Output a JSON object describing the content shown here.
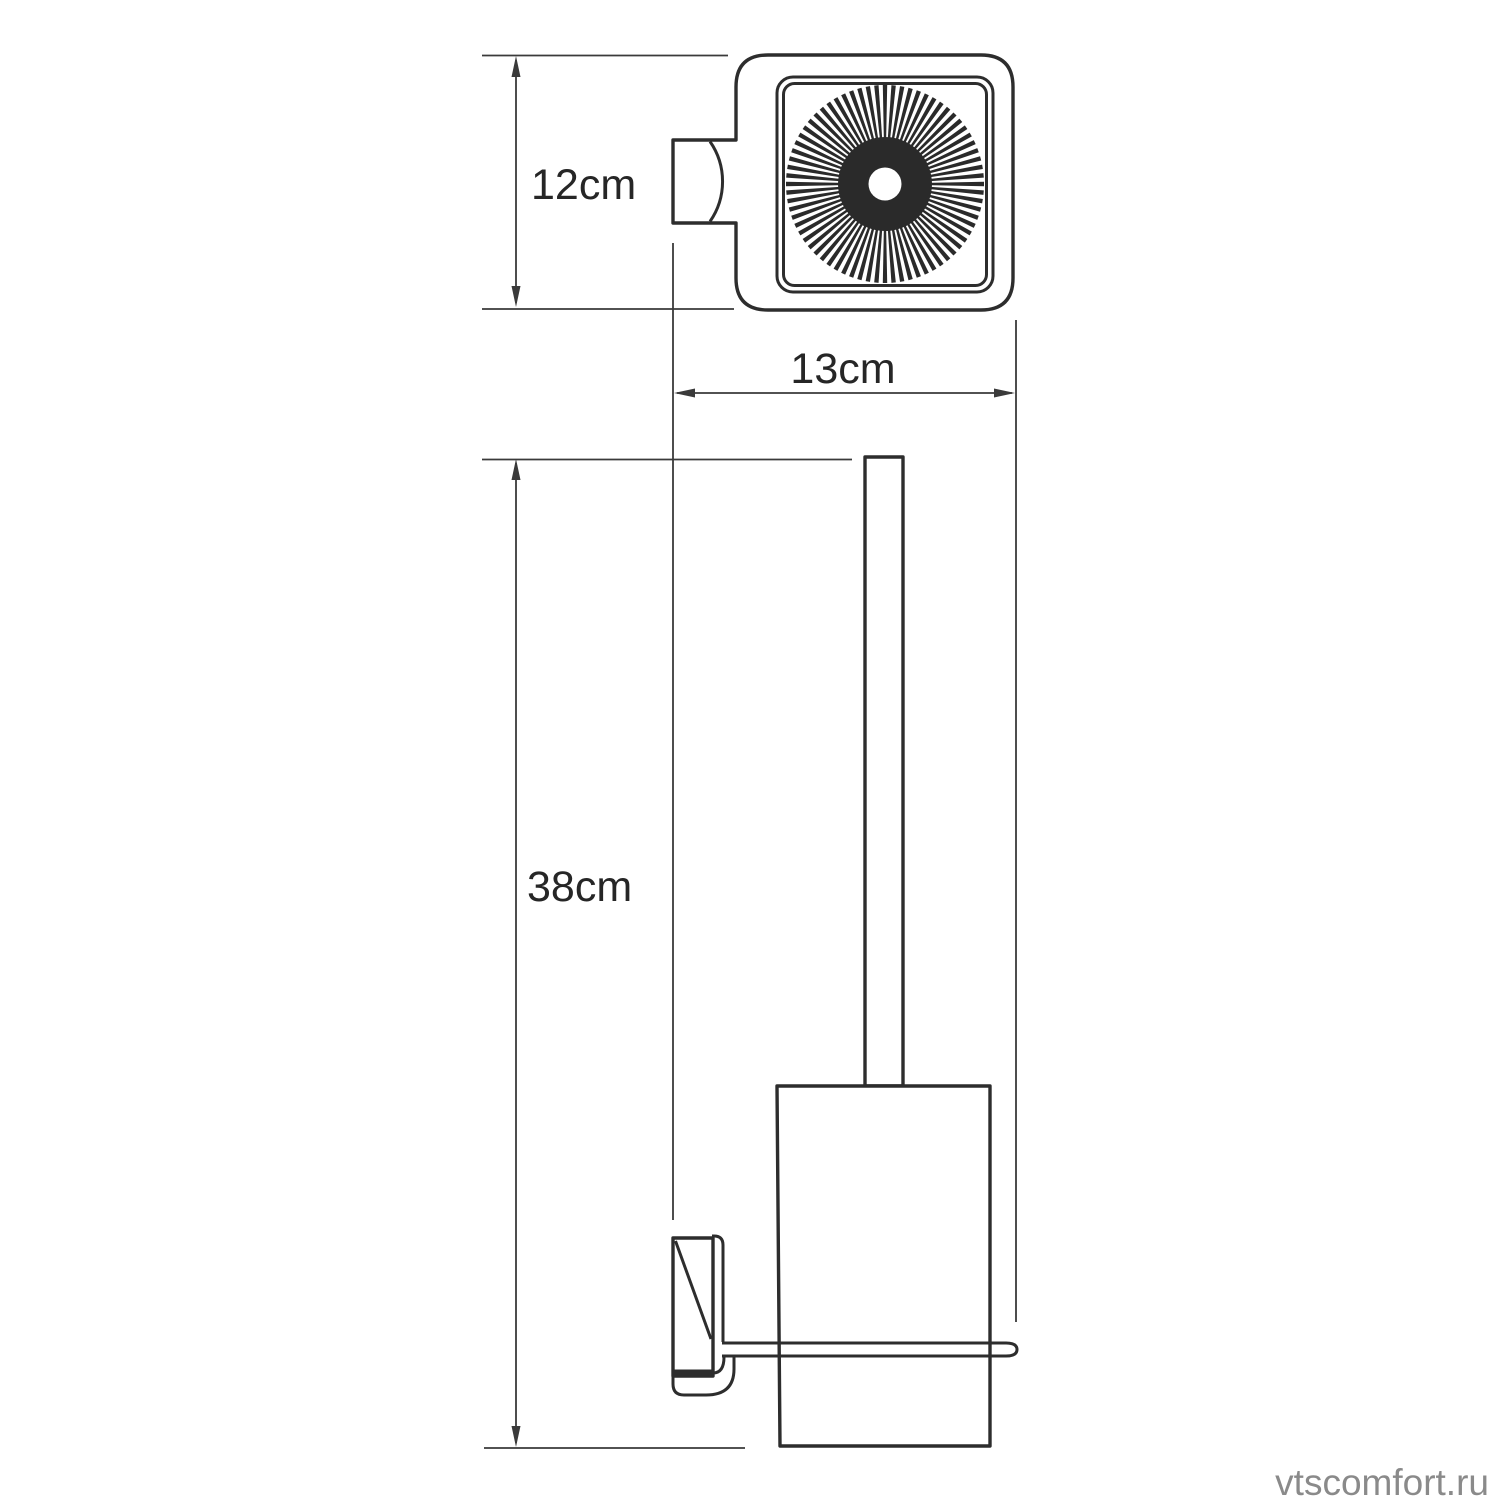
{
  "dimensions": {
    "top_view_height": "12cm",
    "top_view_width": "13cm",
    "front_view_height": "38cm"
  },
  "watermark": "vtscomfort.ru",
  "colors": {
    "line": "#2d2d2d",
    "dimension_line": "#3a3a3a",
    "text": "#262626",
    "watermark": "#8a8a8a",
    "background": "#ffffff"
  }
}
